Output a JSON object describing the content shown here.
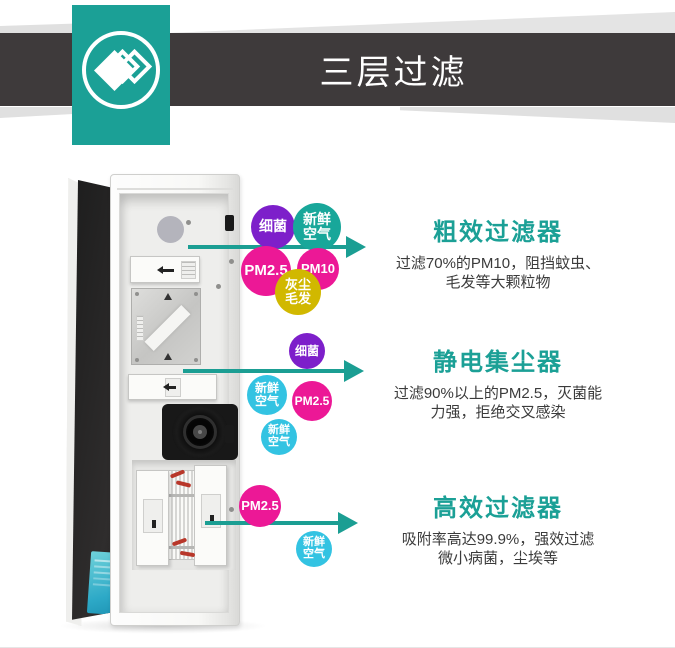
{
  "header": {
    "title": "三层过滤",
    "colors": {
      "banner": "#3e3a3b",
      "accent": "#1ba096",
      "title_text": "#ffffff"
    }
  },
  "logo": {
    "icon": "layered-diamond-chevron-icon"
  },
  "arrow_color": "#1b9e93",
  "sections": [
    {
      "title": "粗效过滤器",
      "body": "过滤70%的PM10，阻挡蚊虫、\n毛发等大颗粒物"
    },
    {
      "title": "静电集尘器",
      "body": "过滤90%以上的PM2.5，灭菌能\n力强，拒绝交叉感染"
    },
    {
      "title": "高效过滤器",
      "body": "吸附率高达99.9%，强效过滤\n微小病菌，尘埃等"
    }
  ],
  "bubbles": [
    {
      "label": "细菌",
      "color": "#7d1fca"
    },
    {
      "label": "新鲜\n空气",
      "color": "#18a79a"
    },
    {
      "label": "PM2.5",
      "color": "#ec1896"
    },
    {
      "label": "PM10",
      "color": "#ec1896"
    },
    {
      "label": "灰尘\n毛发",
      "color": "#d1b800"
    },
    {
      "label": "细菌",
      "color": "#7d1fca"
    },
    {
      "label": "新鲜\n空气",
      "color": "#33c3e2"
    },
    {
      "label": "PM2.5",
      "color": "#ec1896"
    },
    {
      "label": "新鲜\n空气",
      "color": "#33c3e2"
    },
    {
      "label": "PM2.5",
      "color": "#ec1896"
    },
    {
      "label": "新鲜\n空气",
      "color": "#33c3e2"
    }
  ]
}
